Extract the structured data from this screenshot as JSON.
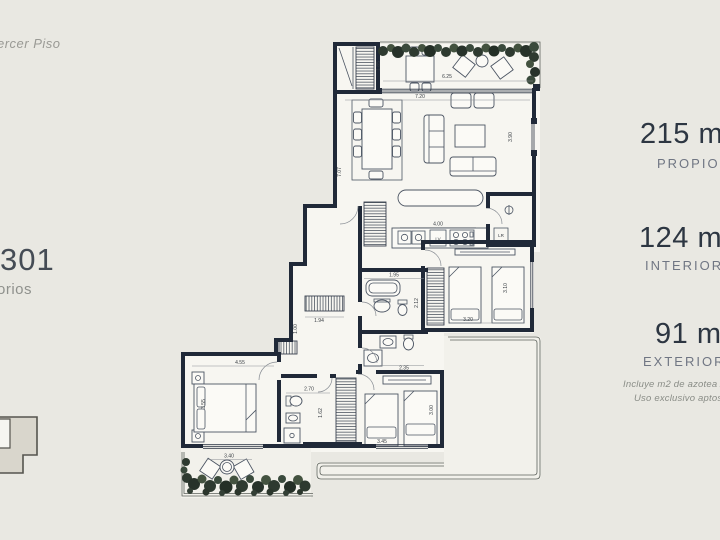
{
  "left_panel": {
    "floor_label": "ercer Piso",
    "unit_number": "301",
    "unit_sub": "orios"
  },
  "right_panel": {
    "areas": [
      {
        "value": "215 m2",
        "label": "PROPIOS"
      },
      {
        "value": "124 m2",
        "label": "INTERIORES"
      },
      {
        "value": "91 m2",
        "label": "EXTERIORES"
      }
    ],
    "footnote_line1": "Incluye m2 de azotea / pa",
    "footnote_line2": "Uso exclusivo aptos P"
  },
  "plan": {
    "dims": {
      "top_terrace_width": "6.25",
      "top_terrace_depth": "1.85",
      "living_width": "7.20",
      "living_height": "7.07",
      "tv_wall": "3.90",
      "kitchen": "4.00",
      "bath_top_width": "1.95",
      "bath_top_depth": "2.12",
      "hall_closet": "1.94",
      "side_niche": "1.00",
      "master_width": "4.55",
      "master_bed": "3.55",
      "master_bath_width": "2.70",
      "master_bath_depth": "1.62",
      "bottom_terrace": "3.40",
      "bath_mid_width": "2.35",
      "bed2_width": "3.45",
      "bed2_depth": "3.00",
      "bed3_width": "3.20",
      "bed3_depth": "3.10"
    },
    "labels": {
      "dishwasher": "LV",
      "laundry": "LR"
    }
  },
  "colors": {
    "page": "#e9e8e2",
    "room": "#f7f6f1",
    "wall": "#202938",
    "line": "#4c5563",
    "accent_text": "#2d3642",
    "muted_text": "#707683",
    "plant": "#2e3a30"
  }
}
